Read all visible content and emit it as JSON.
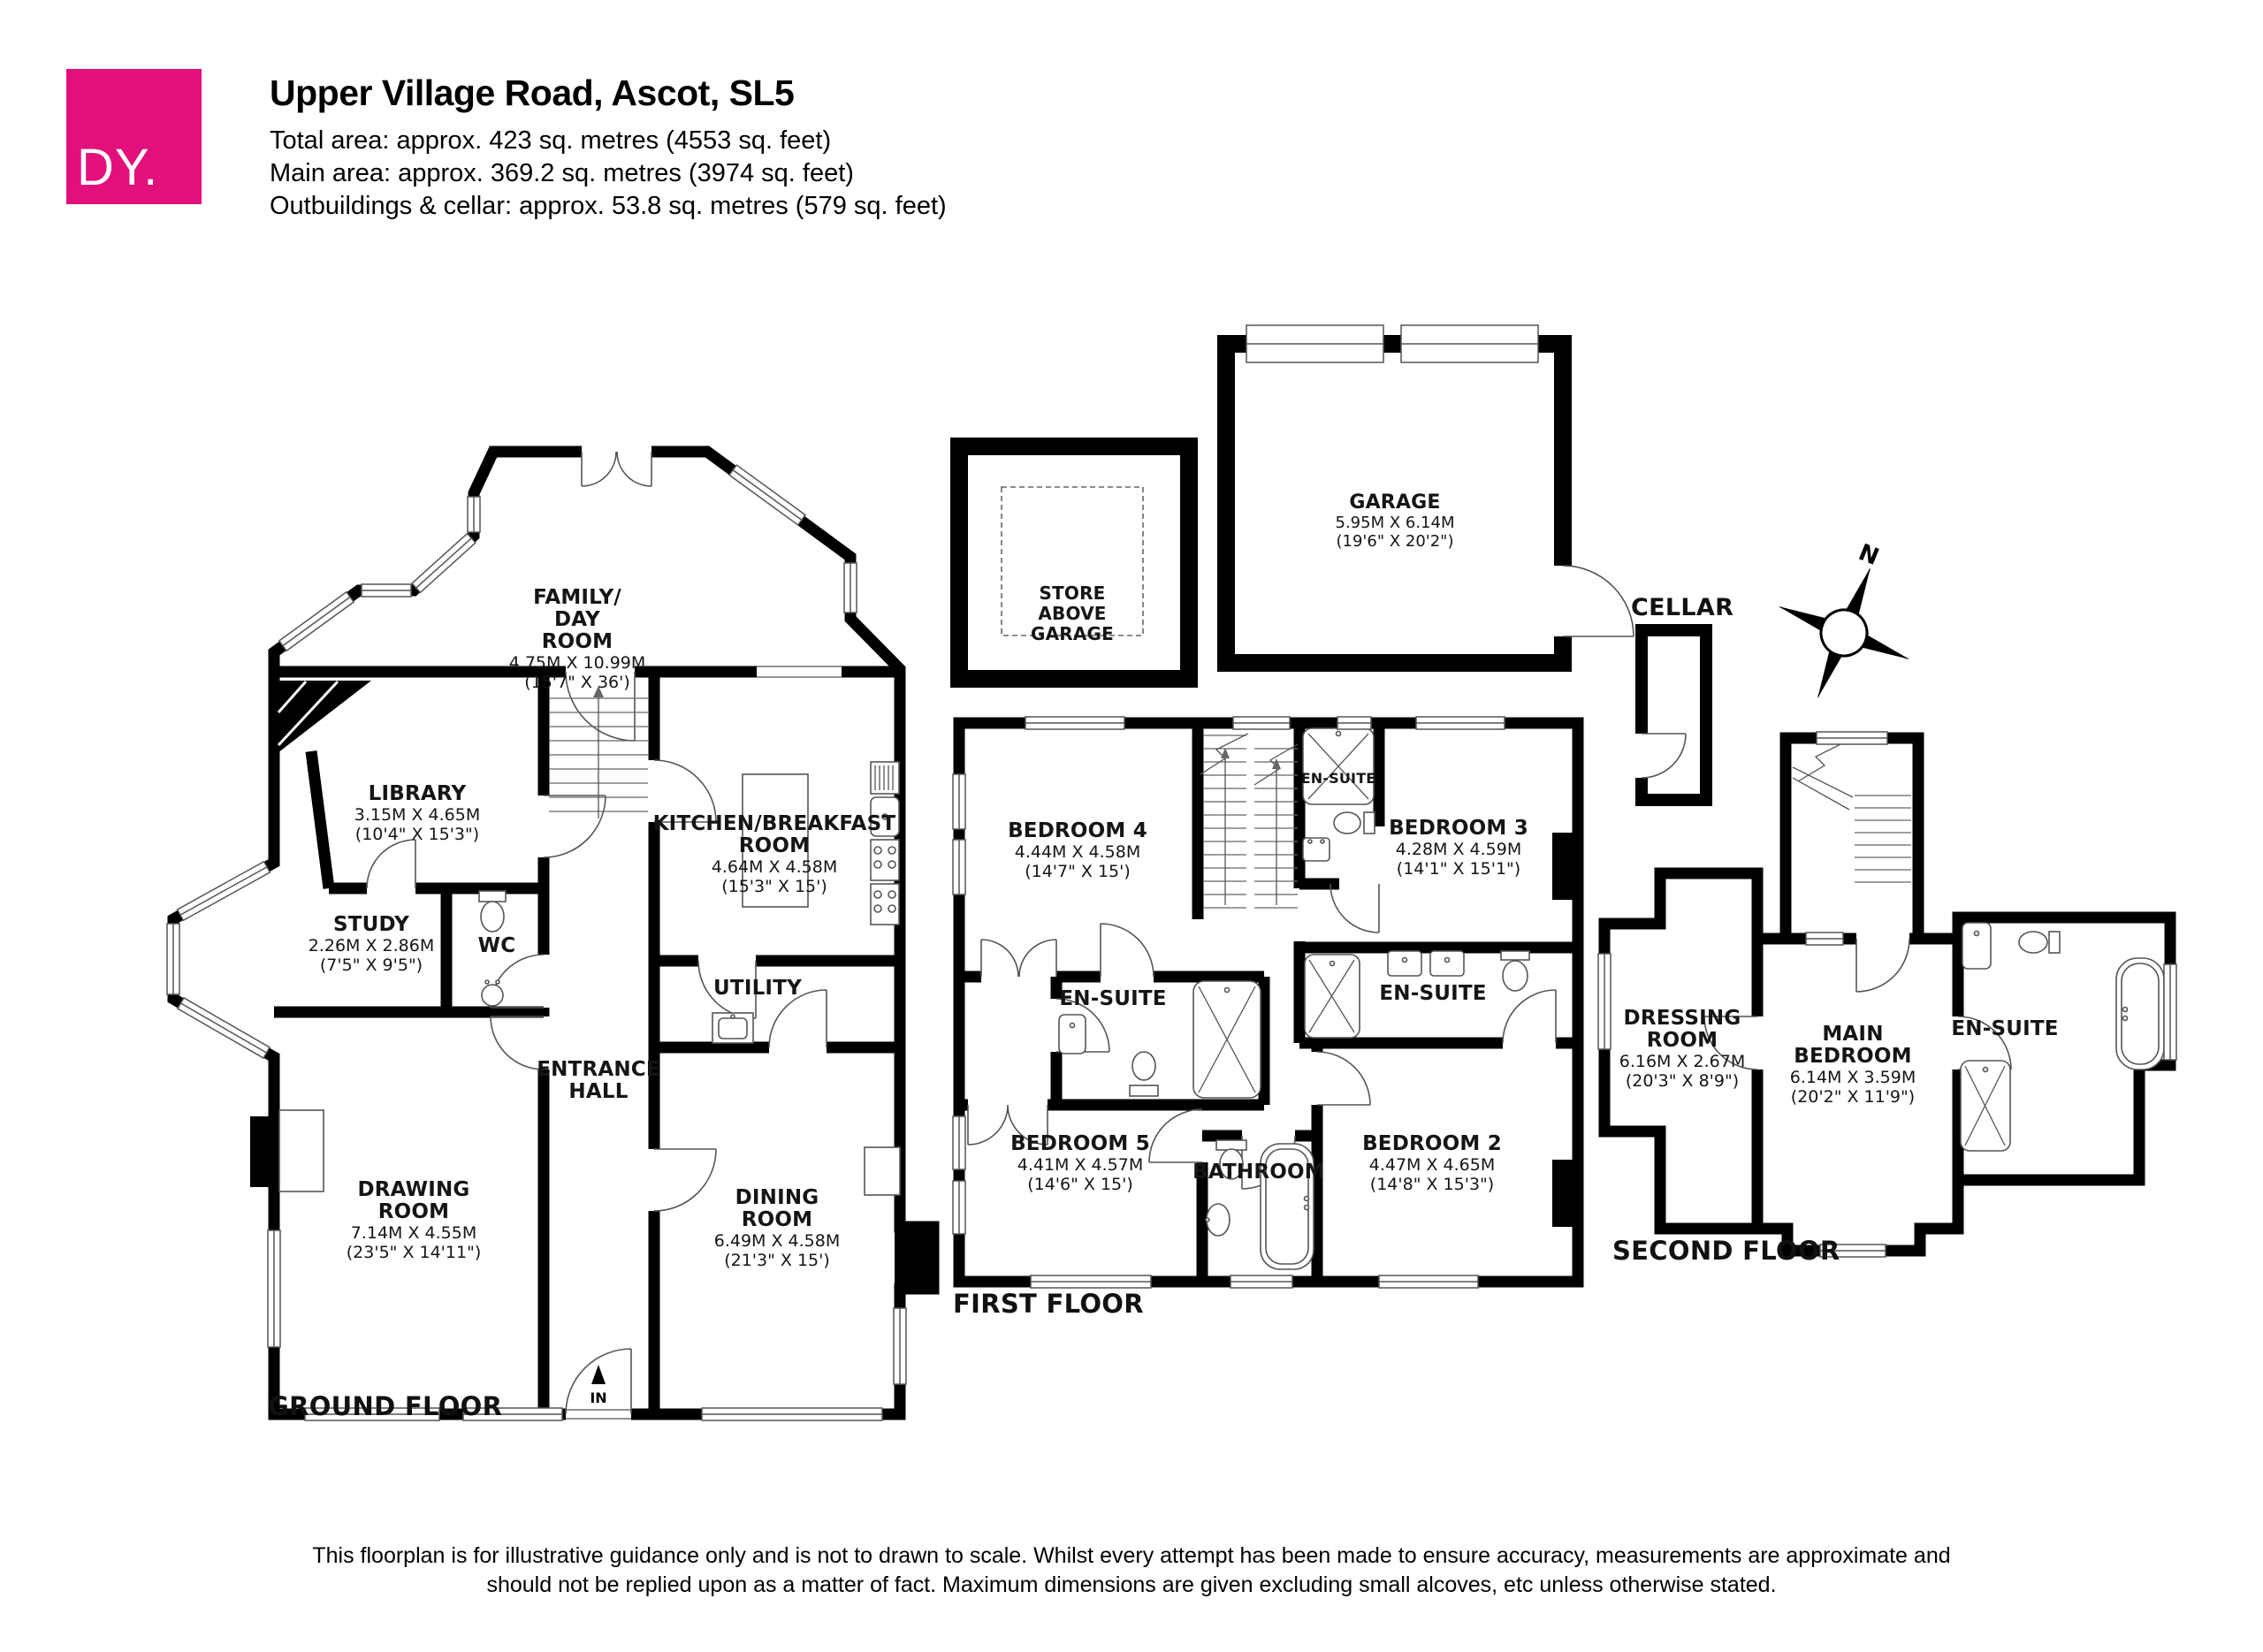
{
  "header": {
    "logo_text": "DY.",
    "title": "Upper Village Road, Ascot, SL5",
    "total_area": "Total area: approx. 423 sq. metres (4553 sq. feet)",
    "main_area": "Main area: approx. 369.2 sq. metres (3974 sq. feet)",
    "outbuildings_area": "Outbuildings & cellar: approx. 53.8 sq. metres (579 sq. feet)"
  },
  "rooms": {
    "family_day": {
      "name": "FAMILY/\nDAY\nROOM",
      "metric": "4.75M X 10.99M",
      "imperial": "(15'7\" X 36')"
    },
    "library": {
      "name": "LIBRARY",
      "metric": "3.15M X 4.65M",
      "imperial": "(10'4\" X 15'3\")"
    },
    "study": {
      "name": "STUDY",
      "metric": "2.26M X 2.86M",
      "imperial": "(7'5\" X 9'5\")"
    },
    "wc": {
      "name": "WC"
    },
    "kitchen": {
      "name": "KITCHEN/BREAKFAST\nROOM",
      "metric": "4.64M X 4.58M",
      "imperial": "(15'3\" X 15')"
    },
    "utility": {
      "name": "UTILITY"
    },
    "entrance_hall": {
      "name": "ENTRANCE\nHALL"
    },
    "drawing_room": {
      "name": "DRAWING\nROOM",
      "metric": "7.14M X 4.55M",
      "imperial": "(23'5\" X 14'11\")"
    },
    "dining_room": {
      "name": "DINING\nROOM",
      "metric": "6.49M X 4.58M",
      "imperial": "(21'3\" X 15')"
    },
    "bedroom4": {
      "name": "BEDROOM 4",
      "metric": "4.44M X 4.58M",
      "imperial": "(14'7\" X 15')"
    },
    "bedroom3": {
      "name": "BEDROOM 3",
      "metric": "4.28M X 4.59M",
      "imperial": "(14'1\" X 15'1\")"
    },
    "ensuite_top": {
      "name": "EN-SUITE"
    },
    "ensuite_left": {
      "name": "EN-SUITE"
    },
    "ensuite_right": {
      "name": "EN-SUITE"
    },
    "bedroom5": {
      "name": "BEDROOM 5",
      "metric": "4.41M X 4.57M",
      "imperial": "(14'6\" X 15')"
    },
    "bathroom": {
      "name": "BATHROOM"
    },
    "bedroom2": {
      "name": "BEDROOM 2",
      "metric": "4.47M X 4.65M",
      "imperial": "(14'8\" X 15'3\")"
    },
    "dressing": {
      "name": "DRESSING\nROOM",
      "metric": "6.16M X 2.67M",
      "imperial": "(20'3\" X 8'9\")"
    },
    "main_bedroom": {
      "name": "MAIN\nBEDROOM",
      "metric": "6.14M X 3.59M",
      "imperial": "(20'2\" X 11'9\")"
    },
    "ensuite_main": {
      "name": "EN-SUITE"
    },
    "store": {
      "name": "STORE\nABOVE\nGARAGE"
    },
    "garage": {
      "name": "GARAGE",
      "metric": "5.95M X 6.14M",
      "imperial": "(19'6\" X 20'2\")"
    },
    "cellar": {
      "name": "CELLAR"
    }
  },
  "floor_labels": {
    "ground": "GROUND FLOOR",
    "first": "FIRST FLOOR",
    "second": "SECOND FLOOR"
  },
  "annotations": {
    "entrance": "IN",
    "compass_north": "N"
  },
  "disclaimer": "This floorplan is for illustrative guidance only and is not to drawn to scale. Whilst every attempt has been made to ensure accuracy, measurements are approximate and should not be replied upon as a matter of fact. Maximum dimensions are given excluding small alcoves, etc unless otherwise stated.",
  "colors": {
    "brand": "#E2107C",
    "wall": "#000000",
    "text": "#151515"
  }
}
